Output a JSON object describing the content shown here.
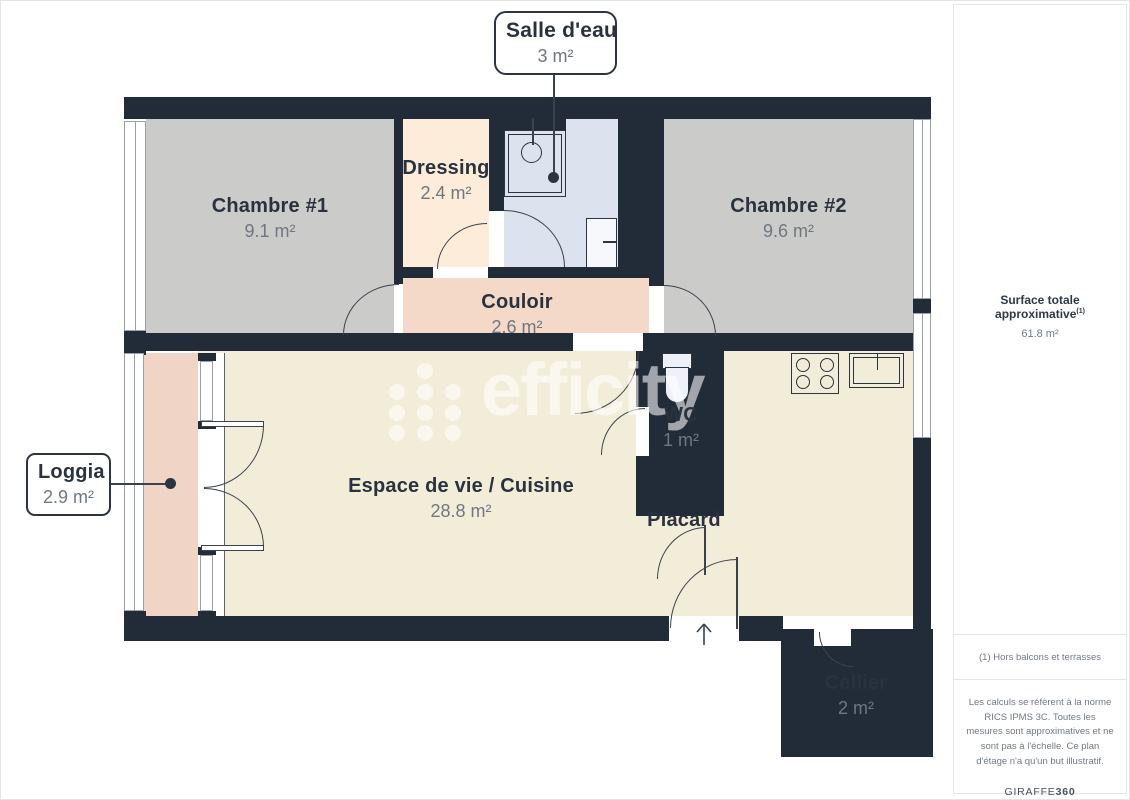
{
  "plan": {
    "rooms": {
      "chambre1": {
        "name": "Chambre #1",
        "area": "9.1 m²"
      },
      "chambre2": {
        "name": "Chambre #2",
        "area": "9.6 m²"
      },
      "dressing": {
        "name": "Dressing",
        "area": "2.4 m²"
      },
      "couloir": {
        "name": "Couloir",
        "area": "2.6 m²"
      },
      "wc": {
        "name": "WC",
        "area": "1 m²"
      },
      "espace": {
        "name": "Espace de vie / Cuisine",
        "area": "28.8 m²"
      },
      "placard": {
        "name": "Placard"
      },
      "cellier": {
        "name": "Cellier",
        "area": "2 m²"
      },
      "salle_deau": {
        "name": "Salle d'eau",
        "area": "3 m²"
      },
      "loggia": {
        "name": "Loggia",
        "area": "2.9 m²"
      }
    },
    "colors": {
      "wall": "#222c39",
      "bedroom_floor": "#cbcbca",
      "dressing_floor": "#fcecd9",
      "couloir_floor": "#f4d8c8",
      "loggia_floor": "#f0d4c6",
      "bathroom_floor": "#dce2ee",
      "living_floor": "#f2edd8",
      "cellier_floor": "#edeff1",
      "placard_floor": "#fafbfc"
    }
  },
  "watermark": {
    "text": "efficity",
    "color": "rgba(255,255,255,0.58)"
  },
  "sidebar": {
    "total_label": "Surface totale approximative",
    "total_sup": "(1)",
    "total_value": "61.8 m²",
    "note": "(1) Hors balcons et terrasses",
    "legal": "Les calculs se réfèrent à la norme RICS IPMS 3C. Toutes les mesures sont approximatives et ne sont pas à l'échelle. Ce plan d'étage n'a qu'un but illustratif.",
    "brand_regular": "GIRAFFE",
    "brand_bold": "360"
  }
}
